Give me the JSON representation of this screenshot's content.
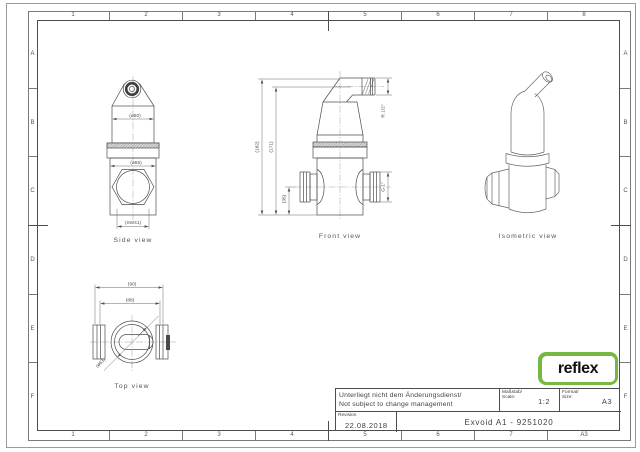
{
  "colors": {
    "line": "#4d4d4d",
    "logo_green": "#78b742"
  },
  "frame": {
    "top_zones": [
      "1",
      "2",
      "3",
      "4",
      "5",
      "6",
      "7",
      "8"
    ],
    "bottom_zones": [
      "1",
      "2",
      "3",
      "4",
      "5",
      "6",
      "7",
      "A3"
    ],
    "left_zones": [
      "A",
      "B",
      "C",
      "D",
      "E",
      "F"
    ],
    "right_zones": [
      "A",
      "B",
      "C",
      "D",
      "E",
      "F"
    ]
  },
  "views": {
    "side": {
      "label": "Side view",
      "dim_dia50": "(ø50)",
      "dim_dia55": "(ø55)",
      "dim_sw41": "(SW41)"
    },
    "front": {
      "label": "Front view",
      "dim_h182": "(182)",
      "dim_h171": "(171)",
      "dim_h35": "(35)",
      "dim_thread_top": "R 1/2\"",
      "dim_thread_side": "G 1\""
    },
    "isometric": {
      "label": "Isometric view"
    },
    "top": {
      "label": "Top view",
      "dim_w90": "(90)",
      "dim_w88": "(88)",
      "dim_dia63": "(ø63)"
    }
  },
  "title_block": {
    "note_de": "Unterliegt nicht dem Änderungsdienst/",
    "note_en": "Not subject to change management",
    "scale_label_de": "Maßstab/",
    "scale_label_en": "Scale:",
    "scale_value": "1:2",
    "format_label_de": "Format/",
    "format_label_en": "Size:",
    "format_value": "A3",
    "revision_label": "Revision",
    "revision_date": "22.08.2018",
    "drawing_title": "Exvoid A1 - 9251020"
  },
  "logo": {
    "text": "reflex"
  }
}
